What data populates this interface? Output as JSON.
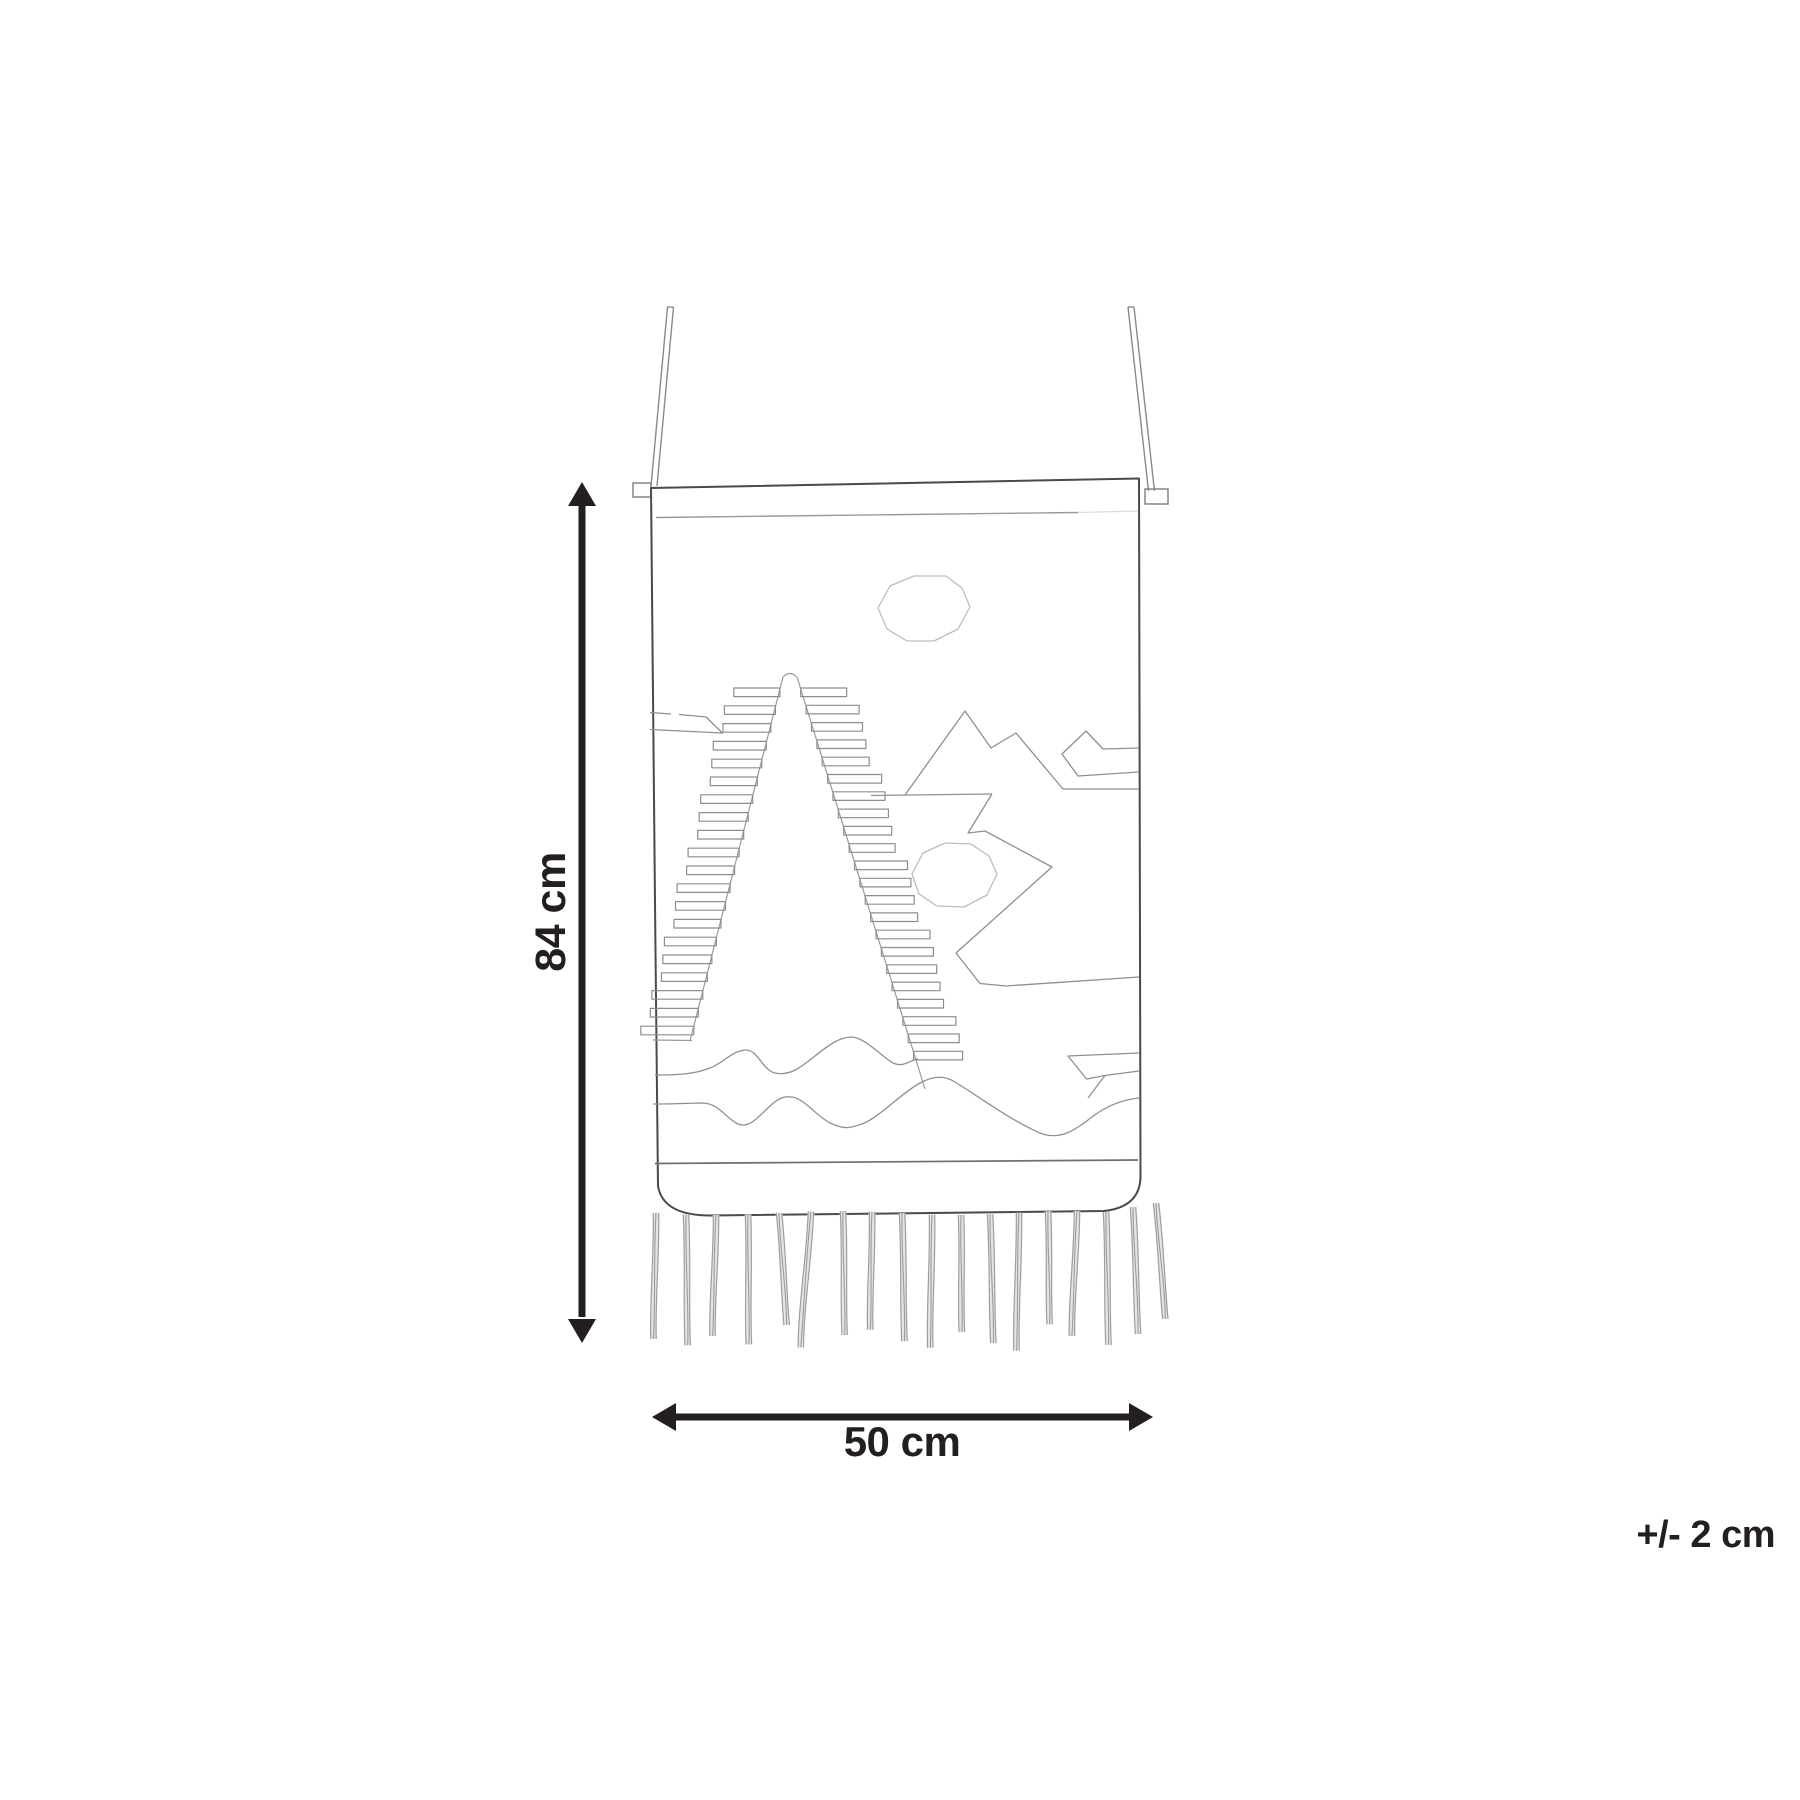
{
  "diagram": {
    "dimension_height": "84 cm",
    "dimension_width": "50 cm",
    "tolerance": "+/- 2 cm",
    "ink_color": "#231f20",
    "outline_color": "#4a4a4a",
    "pattern_line_color": "#8f8f8f",
    "light_motif_color": "#bdbdbd",
    "background": "#ffffff",
    "drawing_parts": [
      "hanging-cord-left",
      "hanging-cord-right",
      "rod-tab-left",
      "rod-tab-right",
      "tapestry-panel",
      "ladder-triangle-motif",
      "octagon-motif-top",
      "octagon-motif-middle",
      "mountain-zigzag-motif",
      "chevron-motif-right",
      "lightning-zigzag-motif",
      "banner-motif-left",
      "wavy-line-upper",
      "wavy-line-lower",
      "arrow-motif-bottom-right",
      "fringe-tassels",
      "vertical-dimension-arrow",
      "horizontal-dimension-arrow"
    ]
  }
}
